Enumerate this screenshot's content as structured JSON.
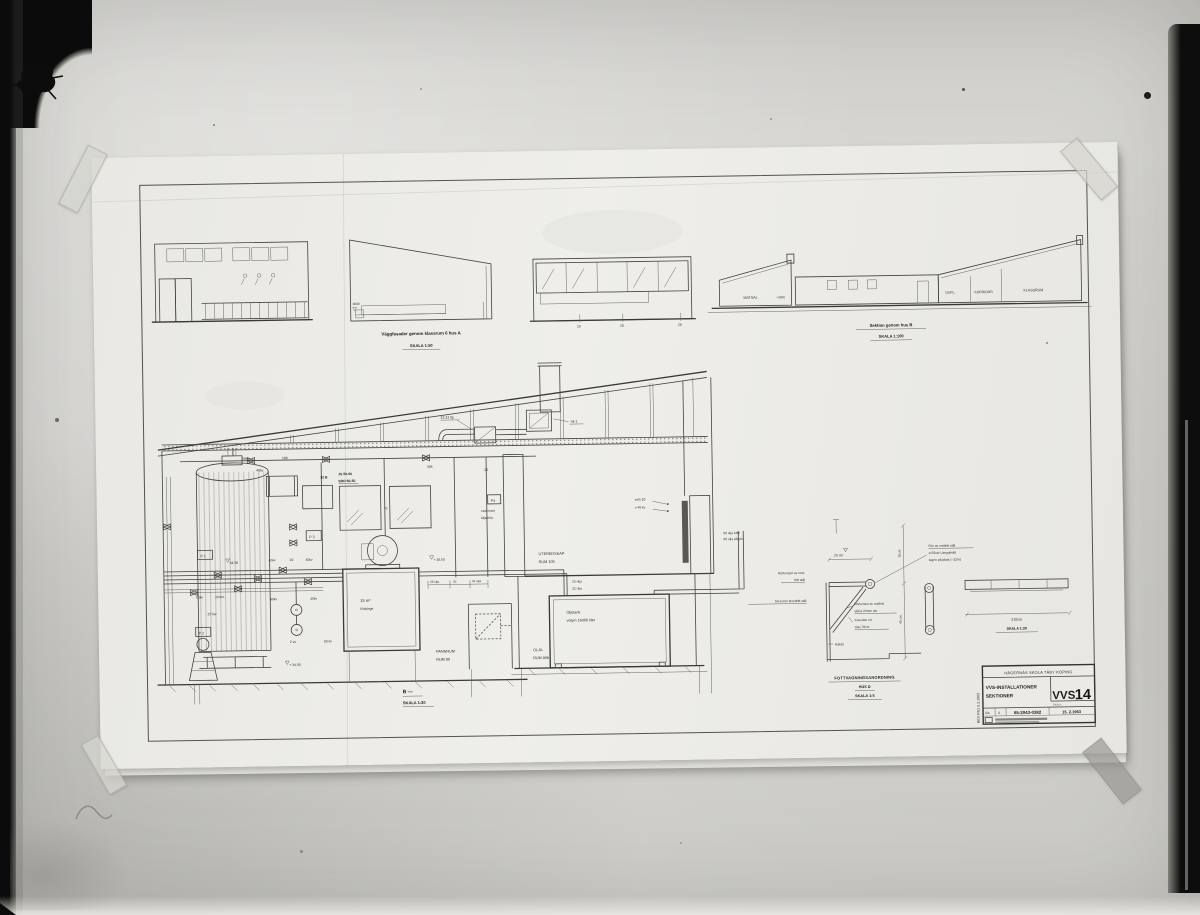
{
  "photo": {
    "wall_color": "#d6d5d1",
    "film_color": "#0b0b0b",
    "sheet_color": "#ebe9e4",
    "line_color": "#45433f"
  },
  "sheet": {
    "elevations": {
      "caption_title": "Väggfasader genom klassrum 6  hus A",
      "caption_scale": "SKALA 1:50",
      "wedge_level": "3600",
      "band_dims": [
        "15",
        "20",
        "20"
      ]
    },
    "section_b": {
      "caption": "Sektion genom hus B",
      "scale": "SKALA 1:100",
      "matsal": "MATSAL",
      "level": "+3600",
      "dupl": "DUPL.",
      "korridor": "KORRIDOR",
      "klassrum": "KLASSRUM"
    },
    "main": {
      "duct_label": "33.33 ltp",
      "fan_label": "Sk-1",
      "d60kv": "60kv",
      "d100": "100",
      "d40kv": "40kv",
      "d32b": "32 B",
      "js": "JS 50-50",
      "sro": "SRO 50-50",
      "d50k": "50k",
      "d20": "20",
      "d70": "70",
      "p1": "P 1",
      "p2": "P 2",
      "p3": "P 3",
      "p4": "P4",
      "motorvent1": "motorvent",
      "motorvent2": "Oljeförbr.",
      "vstn": "vstn 20",
      "v40kv": "v 40 kv",
      "uteredskap1": "UTEREDSKAP",
      "uteredskap2": "RUM 105",
      "lvl3650": "+ 36,50",
      "olja_luftn": "50 olja luftn",
      "olja_pafyln": "50 olja påfyln",
      "olja25": "25 olja",
      "olja32": "32 olja",
      "dimrow1": "25 olja",
      "dimrow2": "32",
      "dimrow3": "32 olja",
      "tank_l1": "Oljetank",
      "tank_l2": "volym 16000 liter",
      "t15_l1": "15 m³",
      "t15_l2": "Kisbinge",
      "pannrum1": "PANNRUM",
      "pannrum2": "RUM 86",
      "olja1": "OLJA",
      "olja2": "RUM 86b",
      "row_60kv": "60kv",
      "row_20mm": "20mm",
      "row_60kv2": "60kv",
      "row_40kv": "40kv",
      "v1_40kv": "40kv",
      "v1_20": "20",
      "v1_40kv2": "40kv",
      "d25hw": "25 hw",
      "d2vv": "2 vv",
      "d50kv": "50 kv",
      "lvl3450a": "34,50",
      "lvl3450b": "+ 34,50",
      "caption": "B —",
      "scale": "SKALA 1:20"
    },
    "detail": {
      "dim25": "25 cm",
      "dim30": "30cm",
      "dim40": "40 cm",
      "dim210": "210cm",
      "rail_scale": "SKALA 1:20",
      "note_pipe1": "Rör av rostfritt stål",
      "note_pipe2": "ø 50utv Längdmått",
      "note_pipe3": "tagen på plats (~32m)",
      "note_konsol1": "Rörkonsol av rost-",
      "note_konsol2": "fritt stål",
      "note_steel": "50-5 mm Rostfritt stål",
      "note_bracket1": "Rörkonsol av rostfritt",
      "note_bracket2": "stål ø 22mm utv",
      "note_cc1": "Konsoler c/c",
      "note_cc2": "max 70cm",
      "note_kakel": "Kakel",
      "caption": "FOTTVAGNINGSANORDNING",
      "caption_sub": "HUS D",
      "caption_scale": "SKALA 1:5"
    },
    "titleblock": {
      "project": "HÄGERNÄS SKOLA   TÄBY KÖPING",
      "subject1": "VVS-INSTALLATIONER",
      "subject2": "SEKTIONER",
      "code": "VVS",
      "number": "14",
      "skala_label": "SKALA",
      "cell_a": "ÖA",
      "cell_b": "A",
      "drawing_no": "65-2043-0382",
      "date": "15. 2.1963",
      "rev": "REV PN1  5.3.1963"
    }
  }
}
